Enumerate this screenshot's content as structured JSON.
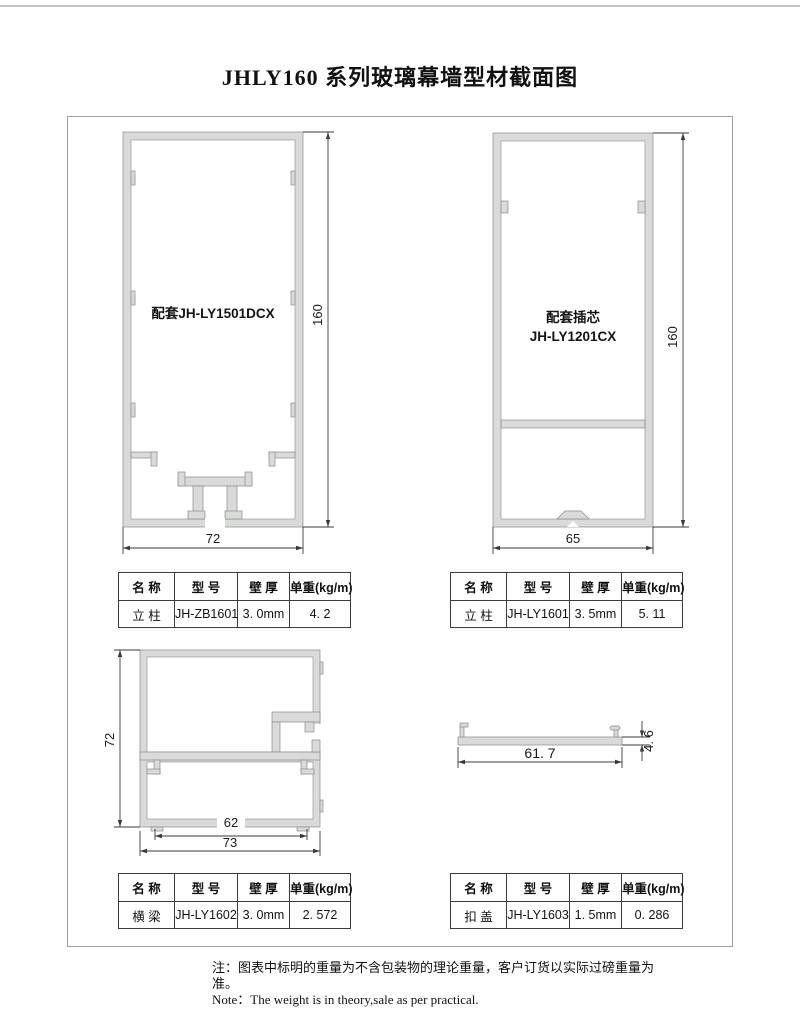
{
  "title": "JHLY160 系列玻璃幕墙型材截面图",
  "colors": {
    "profile_fill": "#d9dbd9",
    "profile_stroke": "#8a8a8a",
    "dimension_line": "#3a3a3a",
    "frame_border": "#a2a2a2",
    "top_divider": "#c2c2c2"
  },
  "drawings": {
    "mullion_a": {
      "label": "配套JH-LY1501DCX",
      "height_dim": "160",
      "width_dim": "72"
    },
    "mullion_b": {
      "label_line1": "配套插芯",
      "label_line2": "JH-LY1201CX",
      "height_dim": "160",
      "width_dim": "65"
    },
    "beam": {
      "height_dim": "72",
      "inner_width_dim": "62",
      "outer_width_dim": "73"
    },
    "cap": {
      "width_dim": "61. 7",
      "height_dim": "4. 6"
    }
  },
  "table_headers": [
    "名 称",
    "型 号",
    "壁 厚",
    "单重(kg/m)"
  ],
  "tables": [
    {
      "name": "立 柱",
      "model": "JH-ZB1601",
      "thickness": "3. 0mm",
      "weight": "4. 2"
    },
    {
      "name": "立 柱",
      "model": "JH-LY1601",
      "thickness": "3. 5mm",
      "weight": "5. 11"
    },
    {
      "name": "横 梁",
      "model": "JH-LY1602",
      "thickness": "3. 0mm",
      "weight": "2. 572"
    },
    {
      "name": "扣 盖",
      "model": "JH-LY1603",
      "thickness": "1. 5mm",
      "weight": "0. 286"
    }
  ],
  "notes": {
    "cn": "注：图表中标明的重量为不含包装物的理论重量，客户订货以实际过磅重量为准。",
    "en": "Note：The weight is in theory,sale as per practical."
  }
}
